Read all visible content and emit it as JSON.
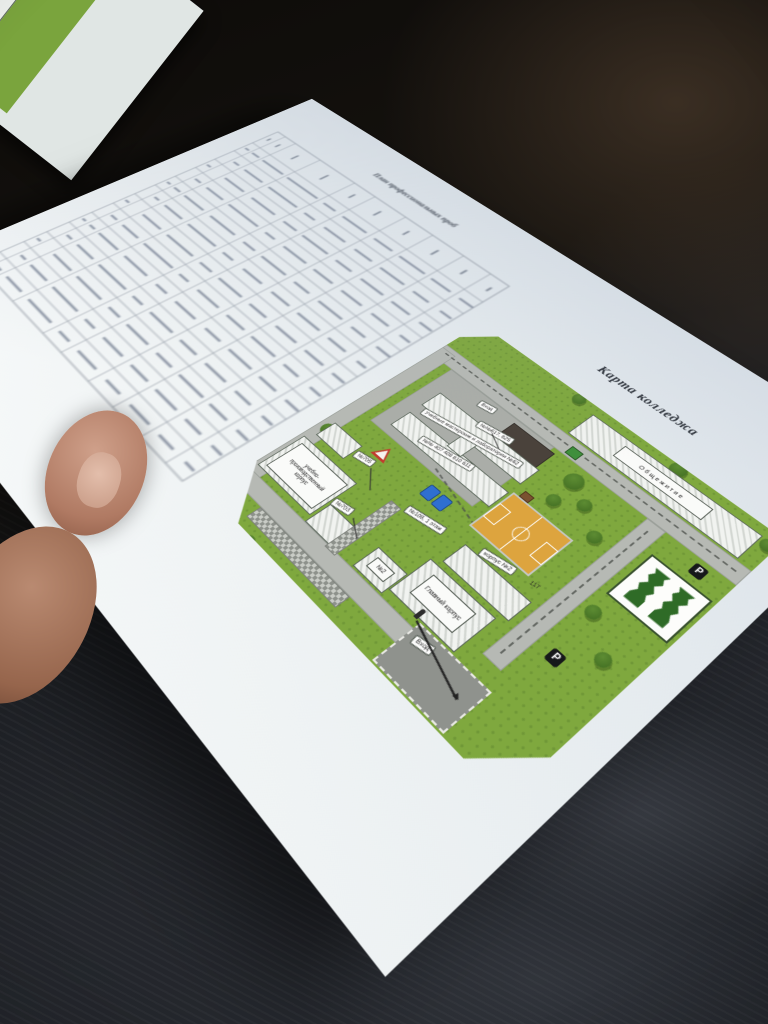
{
  "document": {
    "plan_title": "План профессиональных проб",
    "map_title": "Карта колледжа",
    "table": {
      "note_rows": 13,
      "col_widths": [
        3.5,
        5,
        12,
        16,
        9,
        13,
        11,
        12,
        10,
        8.5
      ],
      "header_bars": [
        40,
        55,
        70,
        80,
        60,
        75,
        65,
        70,
        60,
        50
      ],
      "smudge_rows": [
        [
          60,
          70,
          85,
          90,
          60,
          80,
          70,
          85,
          75,
          60
        ],
        [
          0,
          55,
          75,
          85,
          55,
          70,
          65,
          80,
          60,
          50
        ],
        [
          55,
          0,
          80,
          70,
          65,
          85,
          60,
          75,
          70,
          55
        ],
        [
          0,
          60,
          70,
          88,
          50,
          78,
          72,
          68,
          65,
          45
        ],
        [
          50,
          65,
          82,
          75,
          60,
          82,
          58,
          80,
          55,
          60
        ],
        [
          0,
          50,
          74,
          85,
          55,
          66,
          70,
          76,
          68,
          40
        ],
        [
          58,
          0,
          78,
          80,
          62,
          80,
          64,
          70,
          72,
          55
        ],
        [
          0,
          62,
          68,
          90,
          48,
          74,
          68,
          82,
          58,
          50
        ],
        [
          52,
          58,
          84,
          72,
          58,
          70,
          60,
          78,
          66,
          58
        ],
        [
          0,
          54,
          72,
          86,
          54,
          80,
          66,
          72,
          62,
          48
        ],
        [
          56,
          0,
          80,
          78,
          60,
          76,
          62,
          84,
          70,
          52
        ],
        [
          0,
          58,
          76,
          82,
          52,
          72,
          68,
          74,
          64,
          46
        ],
        [
          48,
          52,
          70,
          76,
          56,
          68,
          58,
          70,
          60,
          42
        ]
      ]
    },
    "map": {
      "labels": {
        "dormitory": "Общежитие",
        "main_building": "Главный корпус",
        "building2_pill": "корпус №2",
        "building2_num": "117",
        "training_building": "учебно-производственный корпус",
        "room_705": "№705",
        "room_703": "№703",
        "rooms_617_625": "№№617, 625",
        "workshops": "Учебные мастерские и лаборатории №62",
        "rooms_row": "№№ 407 408 610 611",
        "entrance_top": "Вход",
        "entrance_parking": "Вход",
        "room_108": "№108, 1 этаж",
        "building_no2": "№2",
        "parking_sign_1": "P",
        "parking_sign_2": "P"
      },
      "colors": {
        "lawn": "#7fa83e",
        "tree": "#4e7d28",
        "road": "#b6b9b4",
        "building_fill": "#f1f3f0",
        "dark_block": "#4a423b",
        "court_orange": "#dda43e",
        "parking_gray": "#8f928d",
        "logo_green": "#2f6b27",
        "equipment_blue": "#2f6fd0",
        "warning_red": "#c23b2e"
      }
    }
  }
}
